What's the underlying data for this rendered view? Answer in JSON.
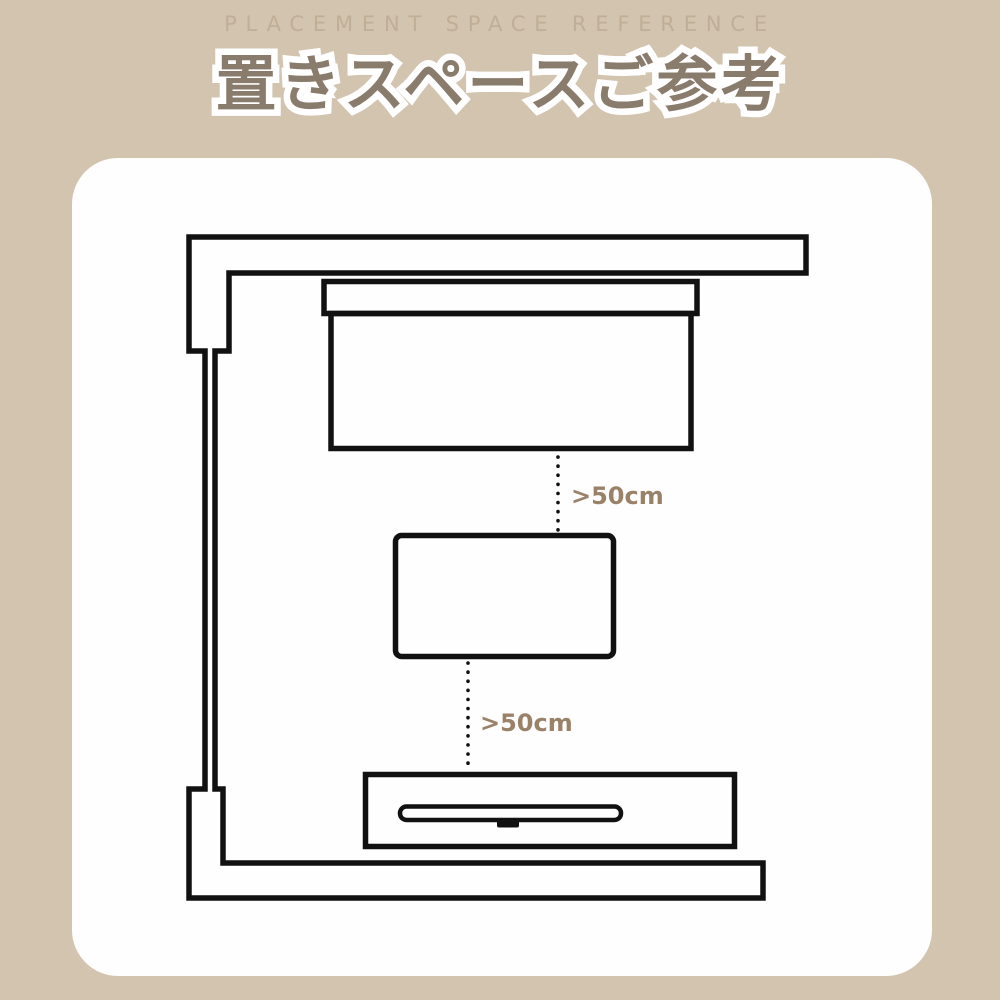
{
  "header": {
    "subtitle": "PLACEMENT SPACE REFERENCE",
    "title": "置きスペースご参考"
  },
  "diagram": {
    "gap_sofa_table": ">50cm",
    "gap_table_tv": ">50cm",
    "furniture": [
      {
        "name": "room-wall"
      },
      {
        "name": "sofa"
      },
      {
        "name": "table"
      },
      {
        "name": "tv-board"
      }
    ]
  },
  "colors": {
    "background": "#d2c4af",
    "card": "#fefefe",
    "line": "#111111",
    "title_fill": "#8a7c6c",
    "title_outline": "#ffffff",
    "subtitle": "#c0ae97",
    "label": "#9a8269"
  }
}
